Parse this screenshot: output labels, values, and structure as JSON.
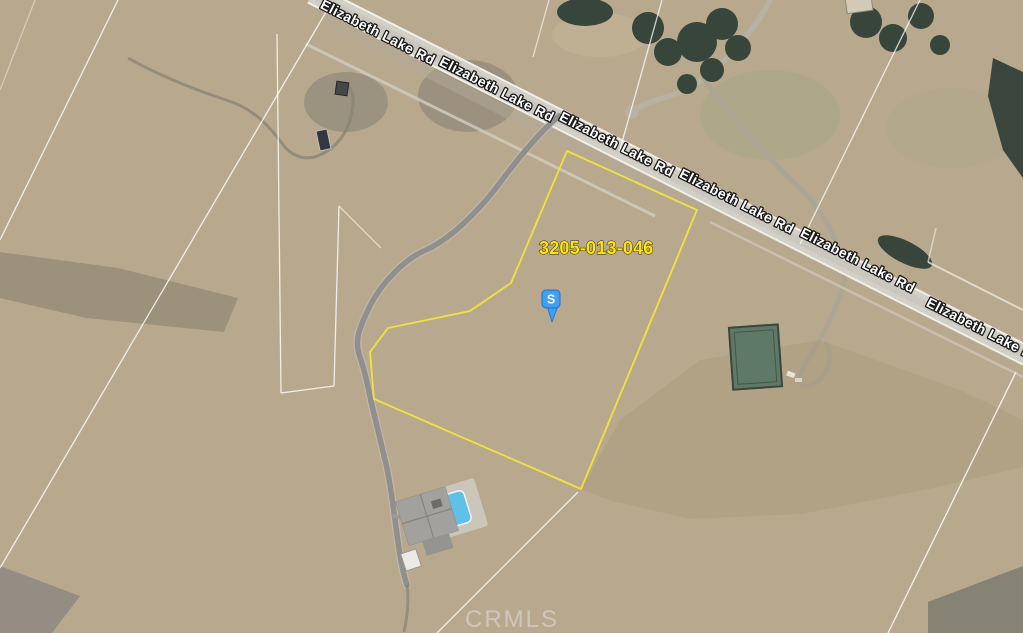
{
  "map": {
    "road_label": "Elizabeth Lake Rd",
    "road_label_occurrences": 6,
    "parcel": {
      "apn_label": "3205-013-046",
      "outline_color": "#f0e23c",
      "label_color": "#ffe608"
    },
    "marker": {
      "letter": "S",
      "body_color": "#3f9ff0",
      "border_color": "#1c6fd1",
      "letter_color": "#ffffff"
    },
    "road_label_style": {
      "fill": "#ffffff",
      "outline": "#000000"
    },
    "watermark": {
      "text": "CRMLS",
      "color": "#e9e9f0"
    },
    "pool_color": "#5fc0e8"
  }
}
